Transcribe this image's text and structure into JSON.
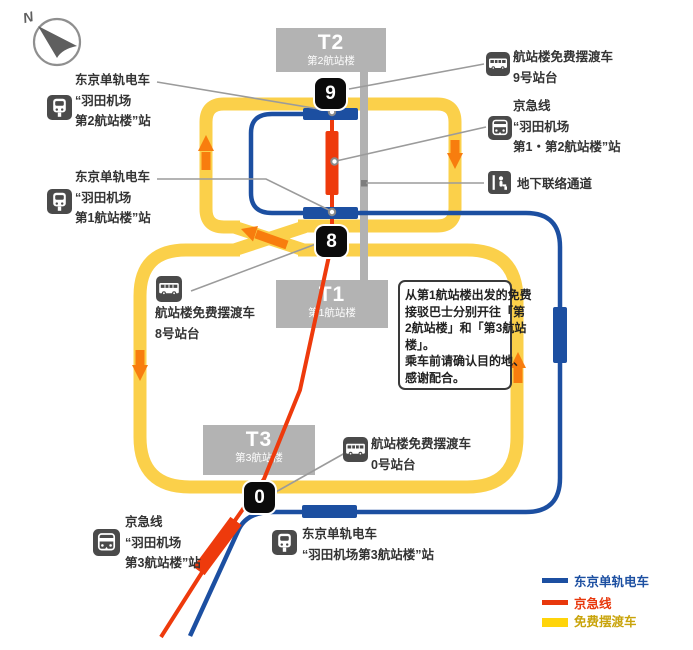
{
  "compass": {
    "label": "N"
  },
  "terminals": {
    "t2": {
      "code": "T2",
      "name": "第2航站楼",
      "badge": "9"
    },
    "t1": {
      "code": "T1",
      "name": "第1航站楼",
      "badge": "8"
    },
    "t3": {
      "code": "T3",
      "name": "第3航站楼",
      "badge": "0"
    }
  },
  "labels": {
    "monorail_t2": {
      "lines": [
        "东京单轨电车",
        "“羽田机场",
        "第2航站楼”站"
      ]
    },
    "monorail_t1": {
      "lines": [
        "东京单轨电车",
        "“羽田机场",
        "第1航站楼”站"
      ]
    },
    "monorail_t3": {
      "lines": [
        "东京单轨电车",
        "“羽田机场第3航站楼”站"
      ]
    },
    "keikyu_t1_t2": {
      "lines": [
        "京急线",
        "“羽田机场",
        "第1・第2航站楼”站"
      ]
    },
    "keikyu_t3": {
      "lines": [
        "京急线",
        "“羽田机场",
        "第3航站楼”站"
      ]
    },
    "shuttle_9": {
      "lines": [
        "航站楼免费摆渡车",
        "9号站台"
      ]
    },
    "shuttle_8": {
      "lines": [
        "航站楼免费摆渡车",
        "8号站台"
      ]
    },
    "shuttle_0": {
      "lines": [
        "航站楼免费摆渡车",
        "0号站台"
      ]
    },
    "underground": "地下联络通道"
  },
  "notice": {
    "lines": [
      "从第1航站楼出发的免费",
      "接驳巴士分别开往「第",
      "2航站楼」和「第3航站",
      "楼」。",
      "乘车前请确认目的地、",
      "感谢配合。"
    ]
  },
  "legend": {
    "items": [
      {
        "label": "东京单轨电车",
        "color": "#1C4FA1",
        "text_color": "#1C4FA1"
      },
      {
        "label": "京急线",
        "color": "#E8380D",
        "text_color": "#E8380D"
      },
      {
        "label": "免费摆渡车",
        "color": "#FFD40A",
        "text_color": "#C9A40B"
      }
    ]
  },
  "colors": {
    "monorail": "#1C4FA1",
    "keikyu": "#EE3A0C",
    "shuttle": "#FBD04A",
    "arrow": "#F87D0E",
    "terminal_box": "#B3B3B3",
    "badge": "#0B0B0B",
    "icon_background": "#4A4A4A",
    "underground_bar": "#B2B2B2"
  }
}
